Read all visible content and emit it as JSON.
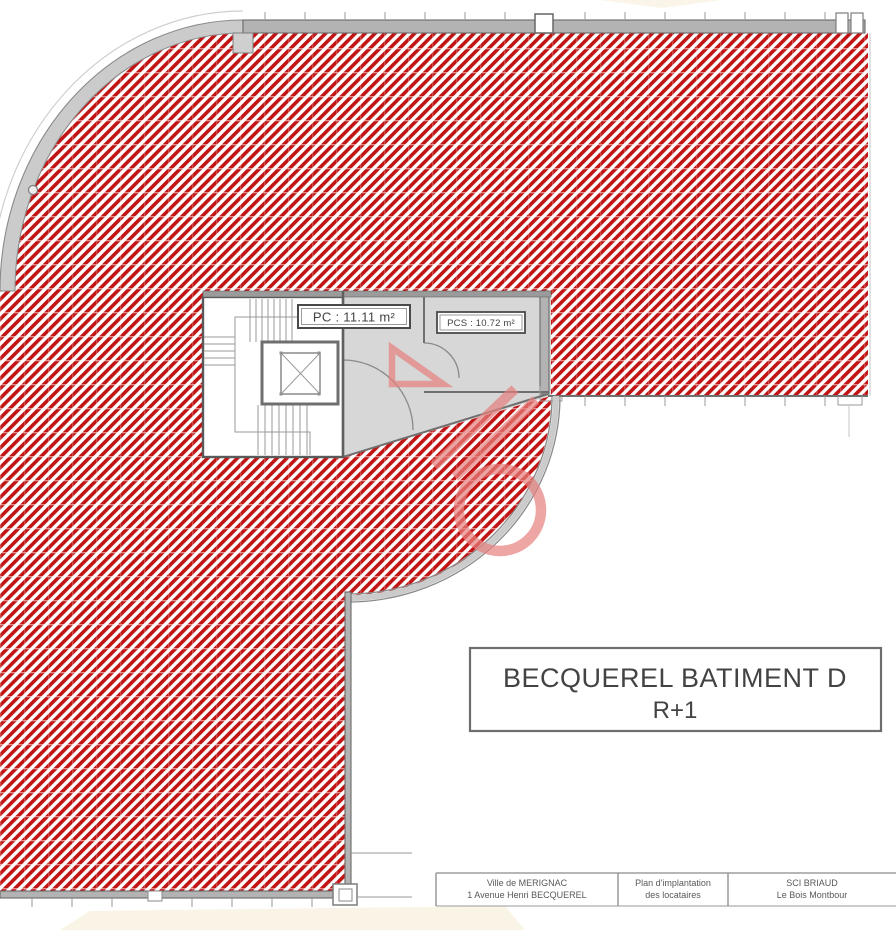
{
  "colors": {
    "hatch_red": "#c11414",
    "wall_gray": "#b3b3b3",
    "room_gray": "#d7d7d7",
    "glazing_gray": "#cbcbcb",
    "line_gray": "#6a6a6a",
    "watermark_pink": "#e5807d",
    "ink": "#434343",
    "muted_ink": "#585858"
  },
  "labels": {
    "pc": "PC : 11.11 m²",
    "pcs": "PCS : 10.72 m²"
  },
  "title_box": {
    "line1": "BECQUEREL BATIMENT D",
    "line2": "R+1"
  },
  "title_block": {
    "cell1": {
      "line1": "Ville de MERIGNAC",
      "line2": "1 Avenue Henri BECQUEREL"
    },
    "cell2": {
      "line1": "Plan d'implantation",
      "line2": "des locataires"
    },
    "cell3": {
      "line1": "SCI BRIAUD",
      "line2": "Le Bois Montbour"
    }
  },
  "icons": {
    "elevator": "elevator-shaft-cross-icon",
    "watermark": "realtor-logo-watermark-icon",
    "hatch": "leased-area-red-hatch"
  }
}
